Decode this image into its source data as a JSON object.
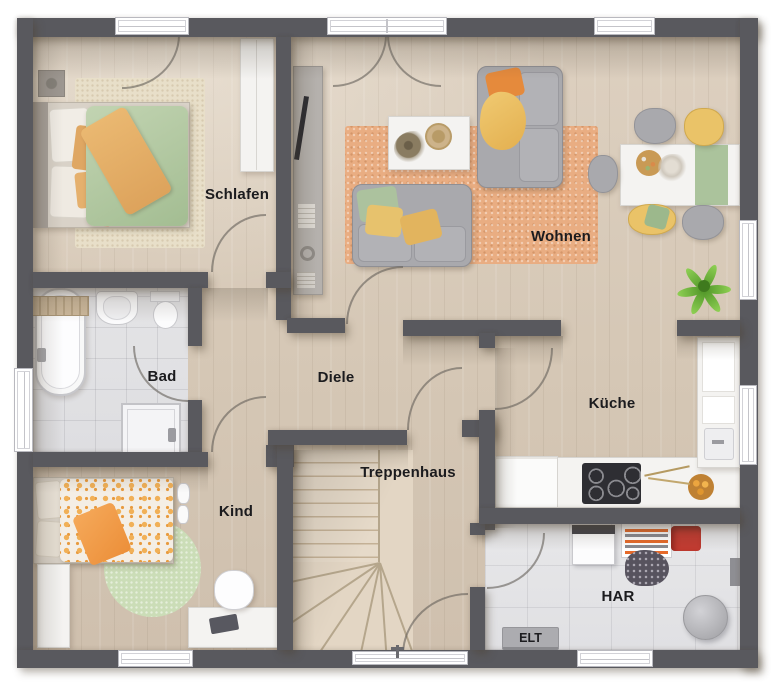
{
  "floorplan": {
    "rooms": {
      "schlafen": {
        "label": "Schlafen"
      },
      "wohnen": {
        "label": "Wohnen"
      },
      "bad": {
        "label": "Bad"
      },
      "diele": {
        "label": "Diele"
      },
      "kueche": {
        "label": "Küche"
      },
      "kind": {
        "label": "Kind"
      },
      "treppenhaus": {
        "label": "Treppenhaus"
      },
      "har": {
        "label": "HAR"
      },
      "elt": {
        "label": "ELT"
      }
    },
    "furniture": {
      "schlafen": [
        "double-bed",
        "rug",
        "wall-lamp",
        "wardrobe"
      ],
      "wohnen": [
        "sideboard",
        "tv",
        "sofa",
        "sofa-2",
        "coffee-table",
        "rug",
        "dining-table",
        "table-runner",
        "chairs",
        "potted-plant"
      ],
      "bad": [
        "bathtub",
        "bath-tray",
        "washbasin",
        "toilet",
        "shower"
      ],
      "kueche": [
        "kitchen-counter",
        "fridge",
        "cooktop",
        "tall-counter-with-sink",
        "fruit-bowl"
      ],
      "kind": [
        "single-bed",
        "round-rug",
        "wardrobe",
        "desk",
        "desk-chair",
        "slippers"
      ],
      "treppenhaus": [
        "winding-staircase",
        "entrance-door"
      ],
      "har": [
        "washing-machine",
        "drying-rack",
        "red-basket",
        "laundry-pile",
        "water-tank",
        "elt-box"
      ]
    },
    "colors": {
      "wall": "#59595e",
      "wood_floor": "#d7cab9",
      "tile_floor": "#e2e2e4",
      "rug_orange": "#e9ad82",
      "textile_yellow": "#eac368",
      "textile_green": "#aec19d",
      "sofa_gray": "#a9a9ad",
      "furniture_white": "#f4f3f1",
      "basket_red": "#c23b31",
      "plant_green": "#6db33f"
    }
  }
}
